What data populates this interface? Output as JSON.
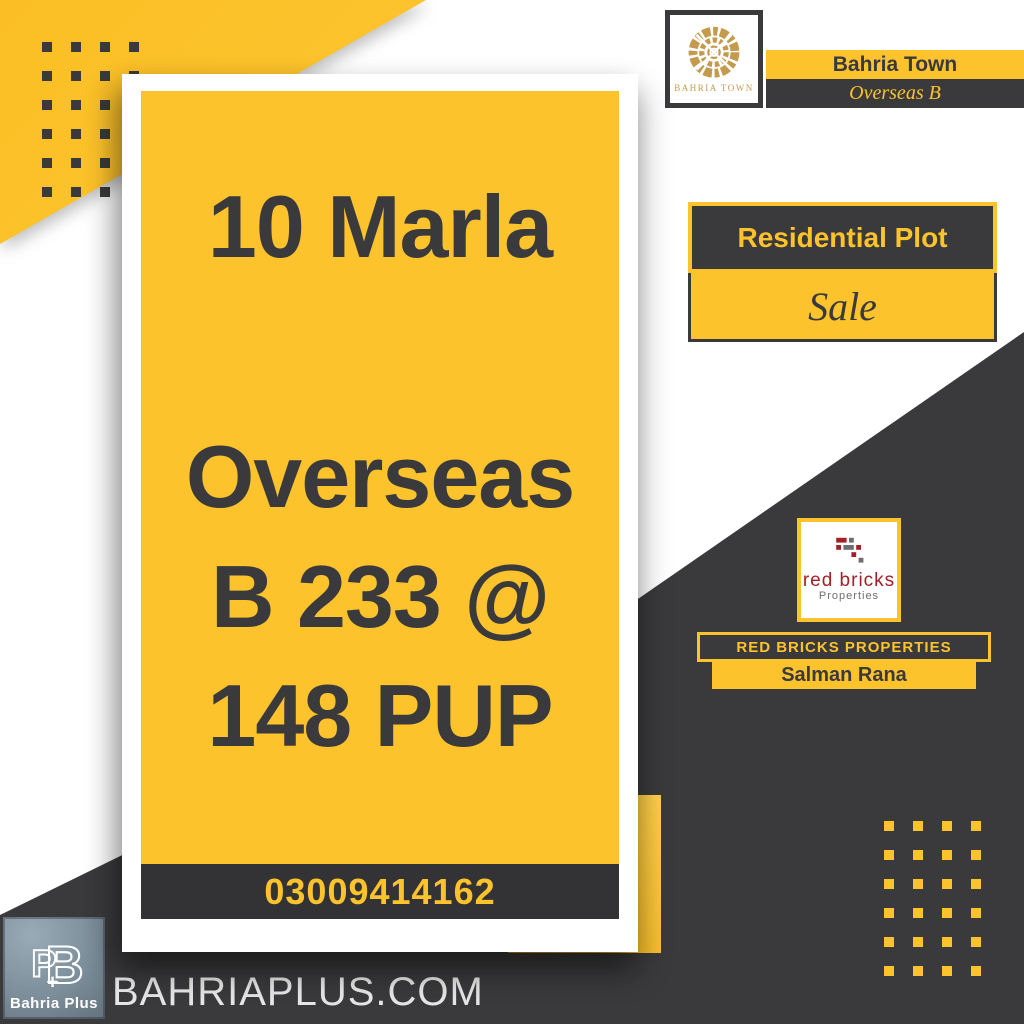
{
  "colors": {
    "yellow": "#FCC32D",
    "dark": "#3A3A3C",
    "phone_bar": "#333335",
    "gold": "#C49A4D",
    "brick_red": "#A32025",
    "brick_gray": "#6D6E70",
    "bp_logo_bg": "#7B8D99",
    "website_text": "#E6E6E6"
  },
  "brand_header": {
    "logo_text": "BAHRIA TOWN",
    "town": "Bahria Town",
    "sector": "Overseas B"
  },
  "listing_badge": {
    "type": "Residential Plot",
    "status": "Sale"
  },
  "card": {
    "size": "10 Marla",
    "line1": "Overseas",
    "line2": "B 233 @",
    "line3": "148 PUP",
    "phone": "03009414162"
  },
  "agency": {
    "logo_title": "red bricks",
    "logo_subtitle": "Properties",
    "bar_title": "RED BRICKS PROPERTIES",
    "agent_name": "Salman Rana"
  },
  "footer": {
    "monogram": {
      "b": "B",
      "p": "P",
      "plus": "+"
    },
    "logo_label": "Bahria Plus",
    "website": "BAHRIAPLUS.COM"
  }
}
